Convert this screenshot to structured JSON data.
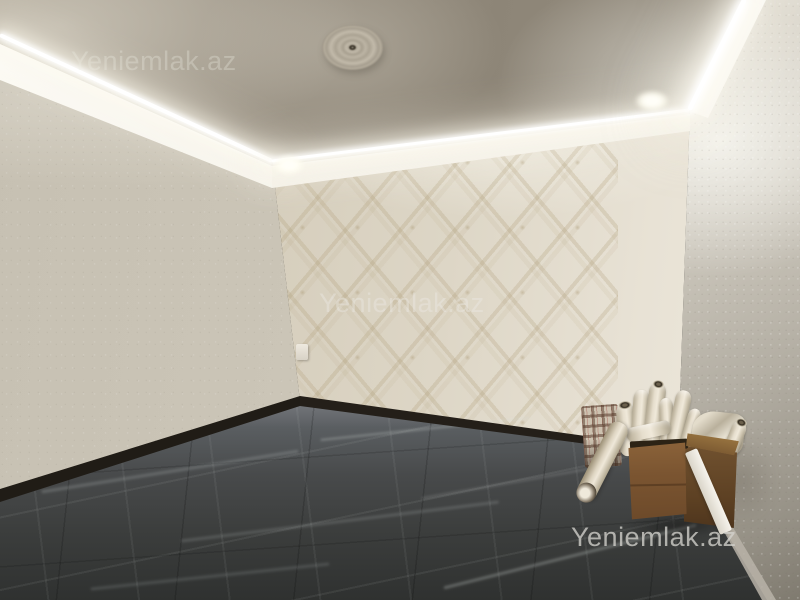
{
  "watermarks": {
    "brand_text": "Yeniemlak.az",
    "positions": [
      "top-left-on-ceiling",
      "center-on-feature-wall",
      "bottom-right-on-floor"
    ]
  },
  "palette": {
    "ceiling": "#948c7e",
    "left_wall": "#cdc7b9",
    "feature_wall": "#dad3c2",
    "wallpaper_motif": "#b4a687",
    "right_wall": "#e9e5db",
    "floor_tile": "#3e403f",
    "floor_vein": "#9aa09d",
    "baseboard_dark": "#221d17",
    "cardboard_box": "#7b5531",
    "led_light": "#ffffff",
    "watermark_gray": "#b9b5ac"
  },
  "scene": {
    "description": "Empty renovated room photographed toward a corner: LED cove ceiling with plaster rosette and recessed spotlights, beige damask wallpaper feature wall, plain textured side walls, dark marble-look tile floor, and in the right corner a cardboard box full of wallpaper rolls beside a plaid bag.",
    "objects": [
      "ceiling-rosette",
      "led-cove-strip-left",
      "led-cove-strip-back",
      "led-cove-strip-right",
      "recessed-spotlight-left",
      "recessed-spotlight-right",
      "crown-molding-cornice",
      "damask-wallpaper-feature-wall",
      "light-switch",
      "dark-marble-tile-floor",
      "dark-baseboard",
      "cardboard-box",
      "wallpaper-rolls",
      "white-trim-strip",
      "plaid-bag"
    ]
  }
}
